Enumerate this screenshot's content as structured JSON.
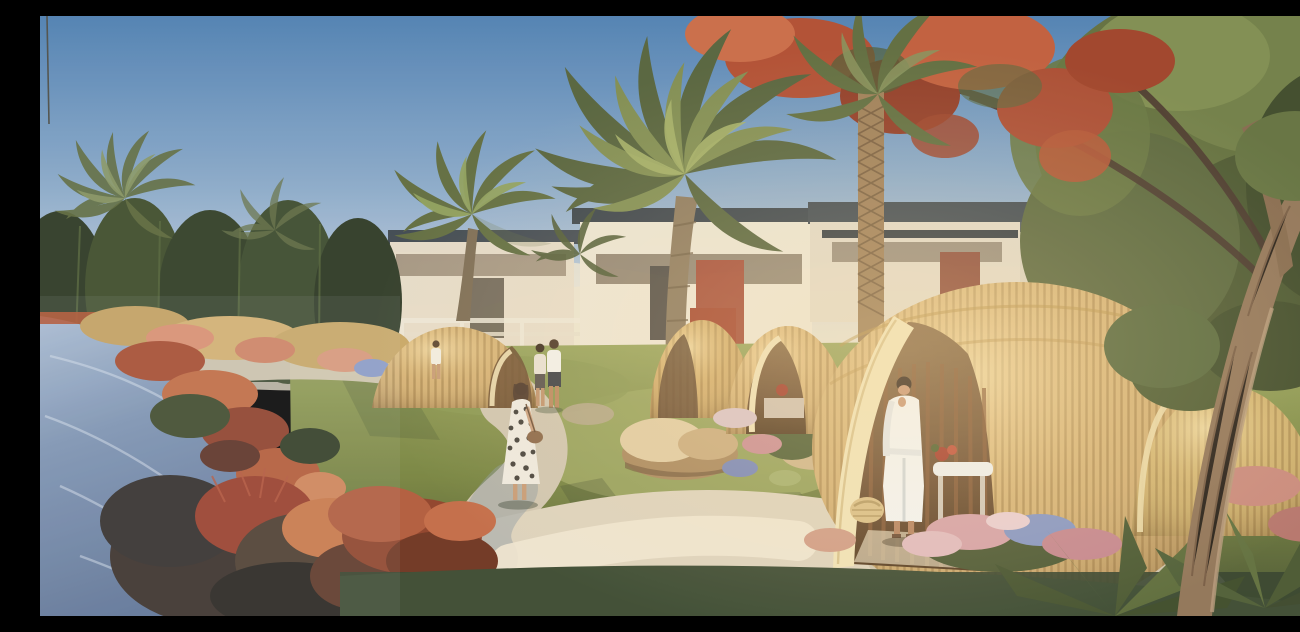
{
  "scene": {
    "description": "Sunlit architectural rendering of a resort spa garden: woven golden rattan dome cabanas on green lawns, a winding stone path, modern flat-roof villas behind date palms, a red-flowering flame tree, a blue stream edged with russet shrubs, guests strolling, and a woman in a white bathrobe standing in the largest dome beside a massage table and a wicker basket.",
    "time_of_day": "late afternoon",
    "elements": [
      "sky",
      "utility-pole",
      "background-villas",
      "left-hedge-trees",
      "stream",
      "stream-bank-shrubs",
      "date-palms",
      "flame-tree",
      "right-tree-mass",
      "lawn",
      "garden-path",
      "rocks",
      "rattan-domes",
      "main-dome-entrance",
      "bathrobe-woman",
      "massage-table",
      "wicker-basket",
      "polka-dot-woman",
      "strolling-couple",
      "distant-walker",
      "foreground-flowerbed",
      "cycad-plants",
      "foreground-tree-trunk"
    ]
  },
  "palette": {
    "sky_top": "#4d7fb2",
    "sky_mid": "#9db8d2",
    "horizon_haze": "#ece4d1",
    "villa_wall": "#e9e0cd",
    "roof_dark": "#39424a",
    "accent_red_door": "#a34630",
    "hedge_green": "#3c4a31",
    "palm_green": "#6b7847",
    "palm_light": "#93a05e",
    "blossom_red": "#af4b2f",
    "water_blue": "#7b92b2",
    "water_deep": "#5b7195",
    "bank_russet": "#b25737",
    "grass_green": "#76833f",
    "grass_shadow": "#3a4930",
    "path_stone": "#d5cab4",
    "path_sunlit": "#efe6d0",
    "path_shade": "#8c99a0",
    "dome_gold": "#d3b074",
    "dome_rim_cream": "#f0e2b6",
    "dome_interior": "#6e4e31",
    "robe_white": "#f3f4f2",
    "skin_tan": "#c89674",
    "flower_pink": "#d5a0a6",
    "flower_blue": "#8594c2",
    "trunk_brown": "#8f7356"
  }
}
